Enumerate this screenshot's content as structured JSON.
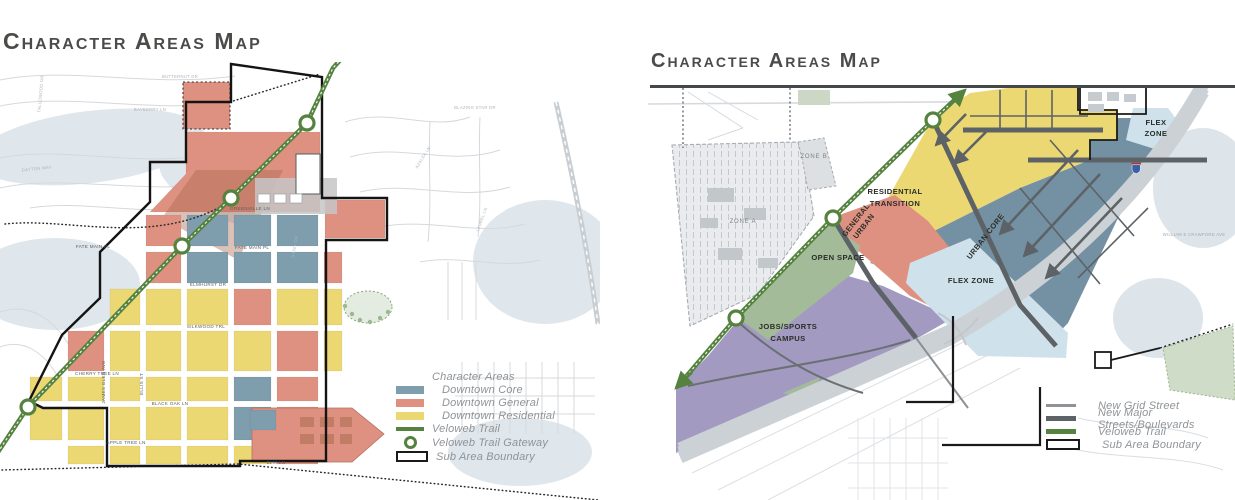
{
  "left_map": {
    "title": "Character Areas Map",
    "legend": {
      "header": "Character Areas",
      "core": "Downtown Core",
      "general": "Downtown General",
      "residential": "Downtown Residential",
      "trail": "Veloweb Trail",
      "gateway": "Veloweb Trail Gateway",
      "boundary": "Sub Area Boundary"
    },
    "streets": {
      "greenville": "GREENVILLE LN",
      "fate_main": "FATE MAIN PL",
      "fate_main_w": "FATE MAIN PL",
      "elmhurst": "ELMHURST DR",
      "silkwood": "SILKWOOD TRL",
      "cherry_tree": "CHERRY TREE LN",
      "black_oak": "BLACK OAK LN",
      "apple_tree": "APPLE TREE LN",
      "elm": "ELM LN",
      "james_glen": "JAMES GLEN AVE",
      "ellis": "ELLIS ST",
      "butternut": "BUTTERNUT DR",
      "blazing_star": "BLAZING STAR DR",
      "daisy": "DAISY DR",
      "azalea": "AZALEA LN",
      "laurel": "LAUREL LN",
      "dayton": "DAYTON WAY",
      "tallowood": "TALLOWOOD DR",
      "bayberry": "BAYBERRY LN"
    }
  },
  "right_map": {
    "title": "Character Areas Map",
    "zones": {
      "residential_transition_1": "RESIDENTIAL",
      "residential_transition_2": "TRANSITION",
      "general_urban_1": "GENERAL",
      "general_urban_2": "URBAN",
      "urban_core": "URBAN CORE",
      "flex_zone_main": "FLEX ZONE",
      "flex_zone_ne_1": "FLEX",
      "flex_zone_ne_2": "ZONE",
      "open_space": "OPEN SPACE",
      "jobs_campus_1": "JOBS/SPORTS",
      "jobs_campus_2": "CAMPUS",
      "zone_a": "ZONE A",
      "zone_b": "ZONE B"
    },
    "labels": {
      "crawford_ave": "WILLIAM E CRAWFORD AVE"
    },
    "legend": {
      "grid_street": "New Grid Street",
      "major_streets": "New Major Streets/Boulevards",
      "veloweb_trail": "Veloweb Trail",
      "boundary": "Sub Area Boundary"
    }
  },
  "colors": {
    "downtown_core": "#7e9dad",
    "downtown_general": "#df9181",
    "downtown_residential": "#ecd873",
    "veloweb_trail_green": "#55823f",
    "urban_core": "#7491a4",
    "flex_zone": "#cfe2ec",
    "open_space": "#a3bb99",
    "jobs_sports_campus": "#a29ac1",
    "major_street_gray": "#5d6266",
    "boundary_black": "#1a1a1a"
  }
}
